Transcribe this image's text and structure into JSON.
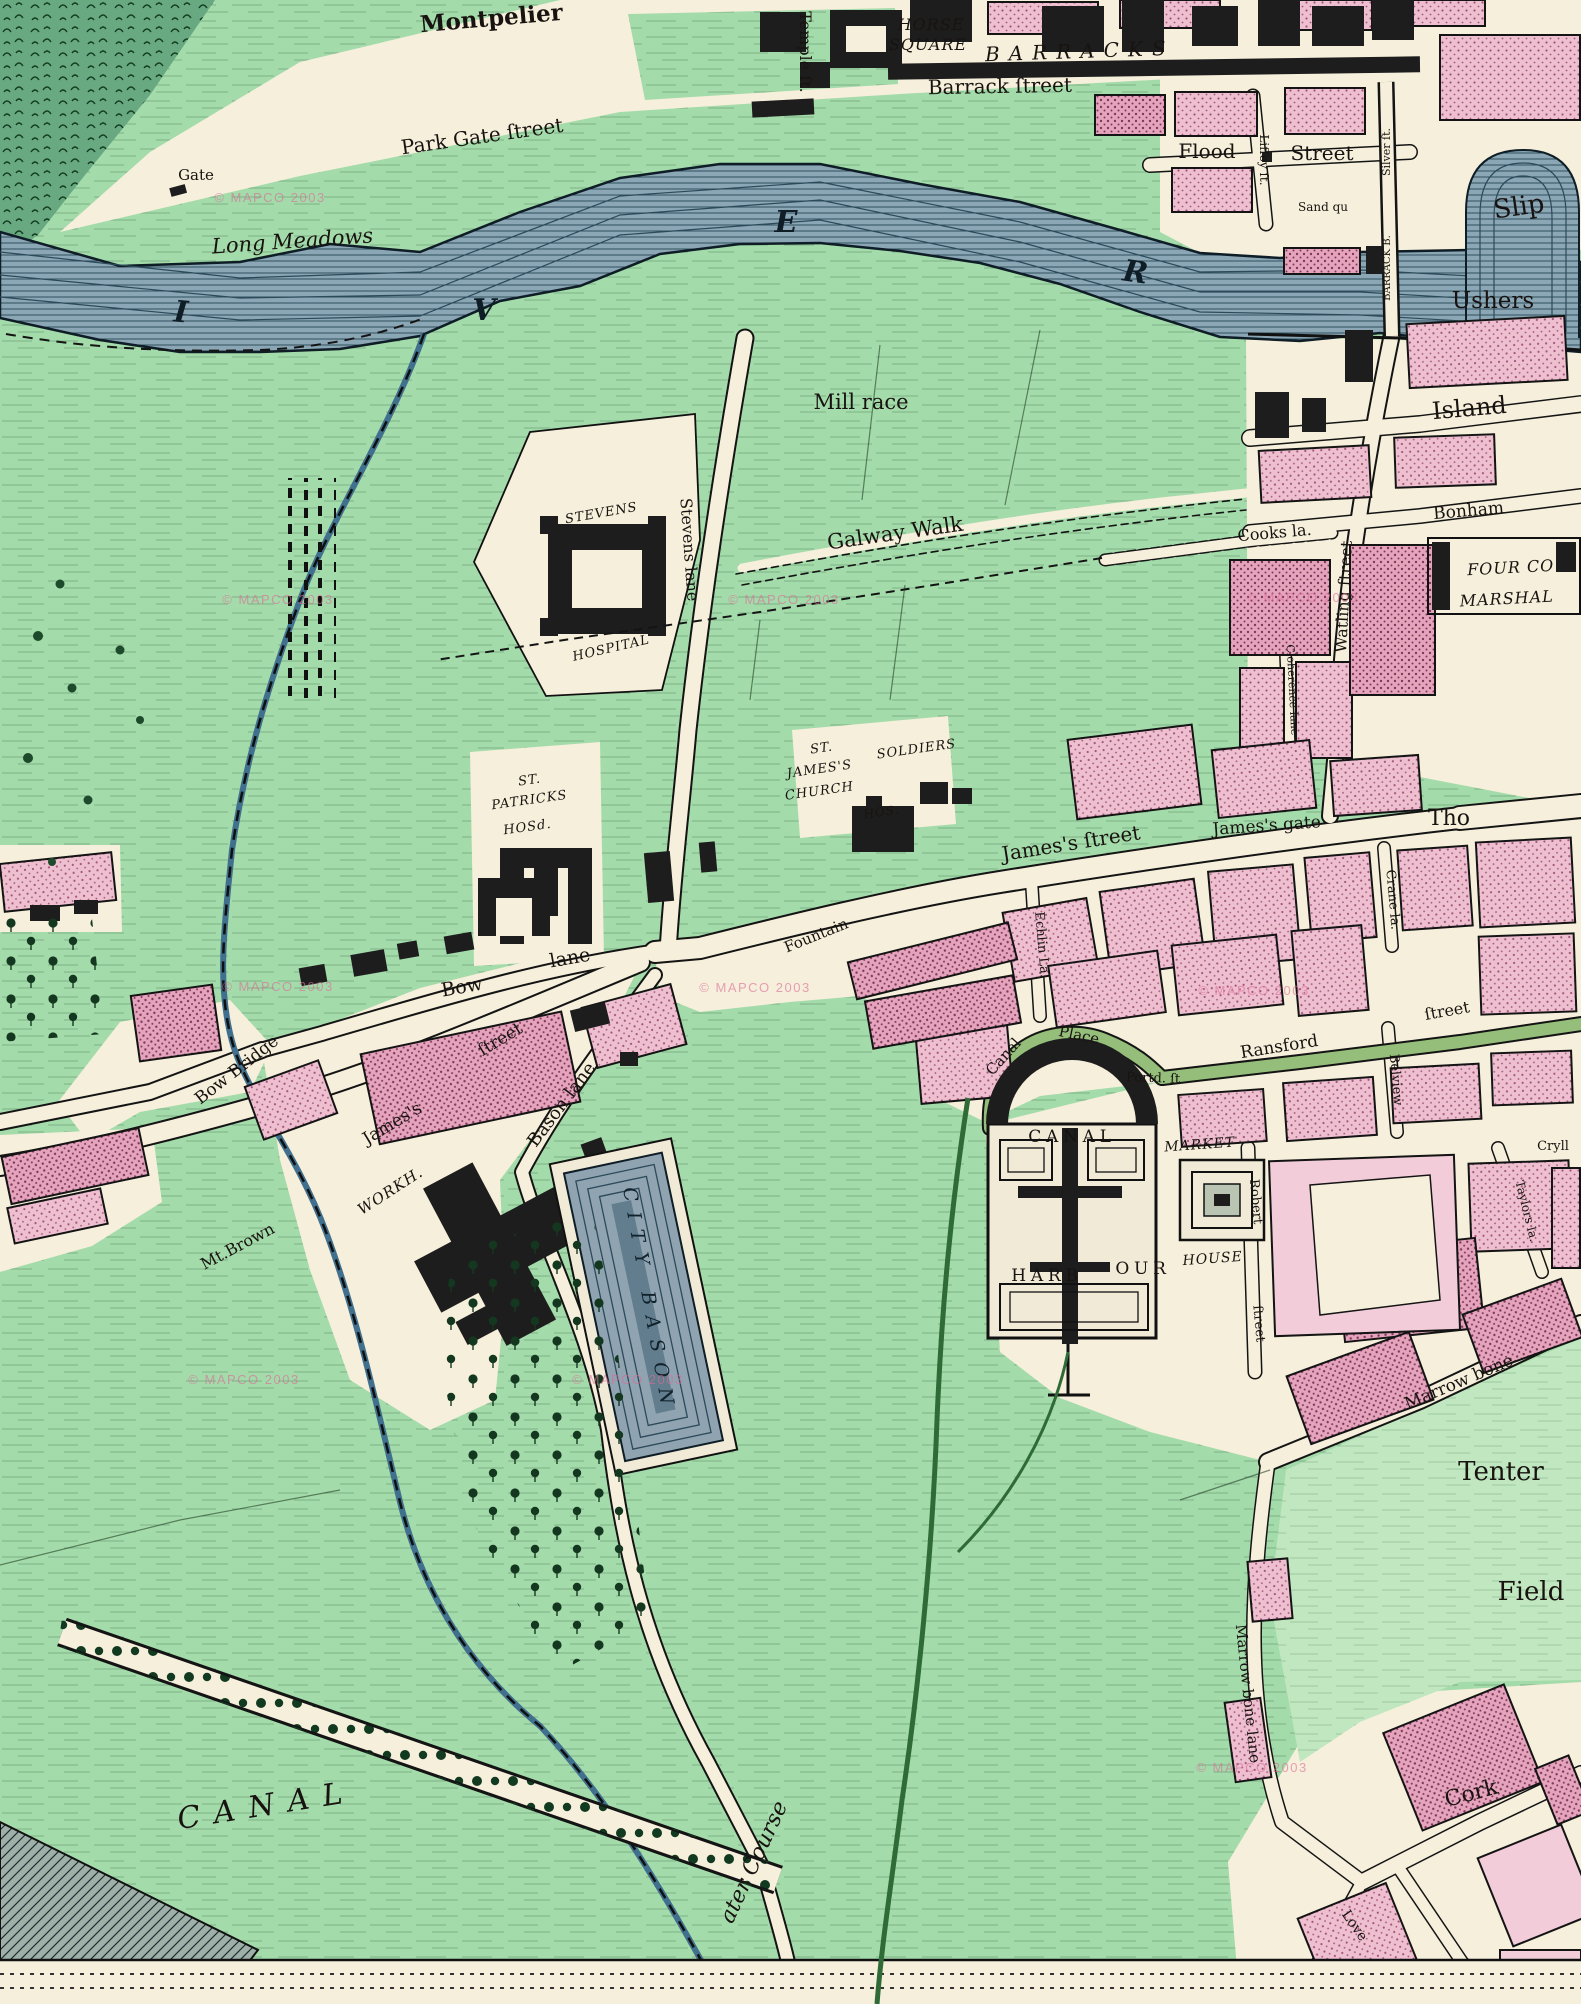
{
  "map": {
    "description": "Hand coloured engraved town map (Dublin, James's Street / Grand Canal Harbour area)",
    "watermark_text": "© MAPCO 2003",
    "colors": {
      "field_green": "#a4dbaa",
      "pale_green": "#c0e7bf",
      "built_cream": "#f5efdb",
      "river_blue": "#8ba6b5",
      "river_line": "#2c4a5a",
      "building_pink": "#eec0cf",
      "building_pink_dark": "#e5a4bb",
      "public_black": "#1d1d1d",
      "road_green": "#94be7a",
      "label_ink": "#181310",
      "watermark_pink": "#db6c98"
    },
    "river_letters": "R I V E R (partial)",
    "labels": [
      {
        "t": "Montpelier",
        "x": 492,
        "y": 26,
        "r": -5,
        "s": 23,
        "c": "b"
      },
      {
        "t": "Temple ſt.",
        "x": 800,
        "y": 52,
        "r": 90,
        "s": 16,
        "c": ""
      },
      {
        "t": "HORSE",
        "x": 931,
        "y": 30,
        "r": 0,
        "s": 16,
        "c": "itc"
      },
      {
        "t": "SQUARE",
        "x": 928,
        "y": 50,
        "r": 0,
        "s": 16,
        "c": "itc"
      },
      {
        "t": "BARRACKS",
        "x": 1080,
        "y": 58,
        "r": -2,
        "s": 20,
        "c": "sp"
      },
      {
        "t": "Barrack ſtreet",
        "x": 1000,
        "y": 93,
        "r": -1,
        "s": 20,
        "c": ""
      },
      {
        "t": "Park Gate ſtreet",
        "x": 483,
        "y": 143,
        "r": -8,
        "s": 20,
        "c": ""
      },
      {
        "t": "Gate",
        "x": 196,
        "y": 180,
        "r": 0,
        "s": 15,
        "c": ""
      },
      {
        "t": "Long Meadows",
        "x": 293,
        "y": 248,
        "r": -4,
        "s": 21,
        "c": "it"
      },
      {
        "t": "Flood",
        "x": 1207,
        "y": 158,
        "r": 0,
        "s": 20,
        "c": ""
      },
      {
        "t": "Street",
        "x": 1322,
        "y": 160,
        "r": 0,
        "s": 20,
        "c": ""
      },
      {
        "t": "Liffey ſt.",
        "x": 1260,
        "y": 160,
        "r": 90,
        "s": 12,
        "c": ""
      },
      {
        "t": "Sand qu",
        "x": 1323,
        "y": 211,
        "r": 0,
        "s": 12,
        "c": ""
      },
      {
        "t": "Silver ſt.",
        "x": 1390,
        "y": 152,
        "r": -90,
        "s": 11,
        "c": ""
      },
      {
        "t": "BARRACK B.",
        "x": 1390,
        "y": 268,
        "r": -90,
        "s": 10,
        "c": ""
      },
      {
        "t": "Slip",
        "x": 1520,
        "y": 215,
        "r": -8,
        "s": 26,
        "c": ""
      },
      {
        "t": "Ushers",
        "x": 1493,
        "y": 308,
        "r": 0,
        "s": 23,
        "c": ""
      },
      {
        "t": "I",
        "x": 180,
        "y": 322,
        "r": 5,
        "s": 30,
        "c": "rl"
      },
      {
        "t": "V",
        "x": 484,
        "y": 320,
        "r": 0,
        "s": 30,
        "c": "rl"
      },
      {
        "t": "E",
        "x": 786,
        "y": 232,
        "r": 0,
        "s": 30,
        "c": "rl"
      },
      {
        "t": "R",
        "x": 1134,
        "y": 282,
        "r": 8,
        "s": 30,
        "c": "rl"
      },
      {
        "t": "Mill race",
        "x": 861,
        "y": 409,
        "r": 0,
        "s": 21,
        "c": ""
      },
      {
        "t": "Galway Walk",
        "x": 896,
        "y": 540,
        "r": -8,
        "s": 21,
        "c": ""
      },
      {
        "t": "Stevens lane",
        "x": 684,
        "y": 550,
        "r": 86,
        "s": 16,
        "c": ""
      },
      {
        "t": "STEVENS",
        "x": 602,
        "y": 517,
        "r": -10,
        "s": 13,
        "c": "itc"
      },
      {
        "t": "HOSPITAL",
        "x": 612,
        "y": 652,
        "r": -13,
        "s": 13,
        "c": "itc"
      },
      {
        "t": "ST.",
        "x": 530,
        "y": 784,
        "r": -8,
        "s": 13,
        "c": "itc"
      },
      {
        "t": "PATRICKS",
        "x": 530,
        "y": 804,
        "r": -8,
        "s": 13,
        "c": "itc"
      },
      {
        "t": "HOSd.",
        "x": 528,
        "y": 831,
        "r": -8,
        "s": 13,
        "c": "itc"
      },
      {
        "t": "ST.",
        "x": 822,
        "y": 752,
        "r": -8,
        "s": 13,
        "c": "itc"
      },
      {
        "t": "JAMES'S",
        "x": 820,
        "y": 773,
        "r": -8,
        "s": 13,
        "c": "itc"
      },
      {
        "t": "CHURCH",
        "x": 820,
        "y": 795,
        "r": -8,
        "s": 13,
        "c": "itc"
      },
      {
        "t": "SOLDIERS",
        "x": 917,
        "y": 753,
        "r": -8,
        "s": 13,
        "c": "itc"
      },
      {
        "t": "HOS.",
        "x": 882,
        "y": 816,
        "r": -8,
        "s": 12,
        "c": "itc"
      },
      {
        "t": "James's ſtreet",
        "x": 1072,
        "y": 850,
        "r": -9,
        "s": 20,
        "c": ""
      },
      {
        "t": "James's gate",
        "x": 1267,
        "y": 831,
        "r": -4,
        "s": 17,
        "c": ""
      },
      {
        "t": "Tho",
        "x": 1449,
        "y": 825,
        "r": 0,
        "s": 22,
        "c": ""
      },
      {
        "t": "Crane la.",
        "x": 1389,
        "y": 900,
        "r": 85,
        "s": 13,
        "c": ""
      },
      {
        "t": "Echlin La.",
        "x": 1038,
        "y": 945,
        "r": 85,
        "s": 13,
        "c": ""
      },
      {
        "t": "Cloherence lane",
        "x": 1289,
        "y": 690,
        "r": 87,
        "s": 11,
        "c": ""
      },
      {
        "t": "Fountain",
        "x": 818,
        "y": 940,
        "r": -22,
        "s": 15,
        "c": ""
      },
      {
        "t": "Bow",
        "x": 463,
        "y": 993,
        "r": -10,
        "s": 19,
        "c": ""
      },
      {
        "t": "lane",
        "x": 571,
        "y": 964,
        "r": -10,
        "s": 19,
        "c": ""
      },
      {
        "t": "Bow Bridge",
        "x": 240,
        "y": 1074,
        "r": -38,
        "s": 17,
        "c": ""
      },
      {
        "t": "James's",
        "x": 395,
        "y": 1128,
        "r": -31,
        "s": 17,
        "c": ""
      },
      {
        "t": "ſtreet",
        "x": 503,
        "y": 1044,
        "r": -31,
        "s": 17,
        "c": ""
      },
      {
        "t": "WORKH.",
        "x": 393,
        "y": 1195,
        "r": -33,
        "s": 15,
        "c": "itc"
      },
      {
        "t": "Mt.Brown",
        "x": 240,
        "y": 1251,
        "r": -28,
        "s": 16,
        "c": ""
      },
      {
        "t": "Bason lane",
        "x": 566,
        "y": 1108,
        "r": -53,
        "s": 18,
        "c": ""
      },
      {
        "t": "CITY BASON",
        "x": 643,
        "y": 1302,
        "r": 80,
        "s": 19,
        "c": "bas"
      },
      {
        "t": "Canal",
        "x": 1007,
        "y": 1060,
        "r": -48,
        "s": 15,
        "c": ""
      },
      {
        "t": "Place",
        "x": 1078,
        "y": 1040,
        "r": 12,
        "s": 15,
        "c": ""
      },
      {
        "t": "Portd. ſt",
        "x": 1153,
        "y": 1082,
        "r": 2,
        "s": 13,
        "c": ""
      },
      {
        "t": "Ransford",
        "x": 1280,
        "y": 1052,
        "r": -9,
        "s": 17,
        "c": ""
      },
      {
        "t": "ſtreet",
        "x": 1448,
        "y": 1016,
        "r": -10,
        "s": 16,
        "c": ""
      },
      {
        "t": "Belview",
        "x": 1392,
        "y": 1080,
        "r": 85,
        "s": 13,
        "c": ""
      },
      {
        "t": "CANAL",
        "x": 1072,
        "y": 1142,
        "r": 0,
        "s": 17,
        "c": "spr"
      },
      {
        "t": "HARB",
        "x": 1047,
        "y": 1281,
        "r": 0,
        "s": 17,
        "c": "spr"
      },
      {
        "t": "OUR",
        "x": 1143,
        "y": 1274,
        "r": 0,
        "s": 17,
        "c": "spr"
      },
      {
        "t": "MARKET",
        "x": 1200,
        "y": 1149,
        "r": -4,
        "s": 14,
        "c": "itc"
      },
      {
        "t": "HOUSE",
        "x": 1213,
        "y": 1263,
        "r": -4,
        "s": 14,
        "c": "itc"
      },
      {
        "t": "Robert",
        "x": 1252,
        "y": 1202,
        "r": 85,
        "s": 13,
        "c": ""
      },
      {
        "t": "ſtreet",
        "x": 1255,
        "y": 1324,
        "r": 85,
        "s": 13,
        "c": ""
      },
      {
        "t": "Marrow bone",
        "x": 1461,
        "y": 1387,
        "r": -23,
        "s": 17,
        "c": ""
      },
      {
        "t": "Taylors la.",
        "x": 1523,
        "y": 1212,
        "r": 76,
        "s": 12,
        "c": ""
      },
      {
        "t": "Cryll",
        "x": 1553,
        "y": 1150,
        "r": 0,
        "s": 13,
        "c": ""
      },
      {
        "t": "Tenter",
        "x": 1501,
        "y": 1480,
        "r": 0,
        "s": 26,
        "c": ""
      },
      {
        "t": "Field",
        "x": 1531,
        "y": 1600,
        "r": 0,
        "s": 26,
        "c": ""
      },
      {
        "t": "Marrow bone lane",
        "x": 1243,
        "y": 1694,
        "r": 84,
        "s": 15,
        "c": ""
      },
      {
        "t": "Cork",
        "x": 1473,
        "y": 1800,
        "r": -15,
        "s": 22,
        "c": ""
      },
      {
        "t": "Love",
        "x": 1351,
        "y": 1928,
        "r": 55,
        "s": 14,
        "c": ""
      },
      {
        "t": "ater Course",
        "x": 760,
        "y": 1865,
        "r": -65,
        "s": 22,
        "c": "it"
      },
      {
        "t": "CANAL",
        "x": 268,
        "y": 1815,
        "r": -9,
        "s": 30,
        "c": "sp"
      },
      {
        "t": "Island",
        "x": 1470,
        "y": 416,
        "r": -5,
        "s": 24,
        "c": ""
      },
      {
        "t": "Bonham",
        "x": 1469,
        "y": 516,
        "r": -5,
        "s": 17,
        "c": ""
      },
      {
        "t": "FOUR CO",
        "x": 1511,
        "y": 573,
        "r": -3,
        "s": 16,
        "c": "itc"
      },
      {
        "t": "MARSHAL",
        "x": 1507,
        "y": 604,
        "r": -3,
        "s": 16,
        "c": "itc"
      },
      {
        "t": "Cooks la.",
        "x": 1275,
        "y": 538,
        "r": -5,
        "s": 16,
        "c": ""
      },
      {
        "t": "Watling ſtreet",
        "x": 1349,
        "y": 597,
        "r": -87,
        "s": 16,
        "c": ""
      }
    ],
    "watermarks": [
      {
        "x": 270,
        "y": 202
      },
      {
        "x": 278,
        "y": 604
      },
      {
        "x": 784,
        "y": 604
      },
      {
        "x": 1303,
        "y": 602
      },
      {
        "x": 278,
        "y": 991
      },
      {
        "x": 755,
        "y": 992
      },
      {
        "x": 1254,
        "y": 995
      },
      {
        "x": 244,
        "y": 1384
      },
      {
        "x": 628,
        "y": 1384
      },
      {
        "x": 1252,
        "y": 1772
      }
    ]
  }
}
